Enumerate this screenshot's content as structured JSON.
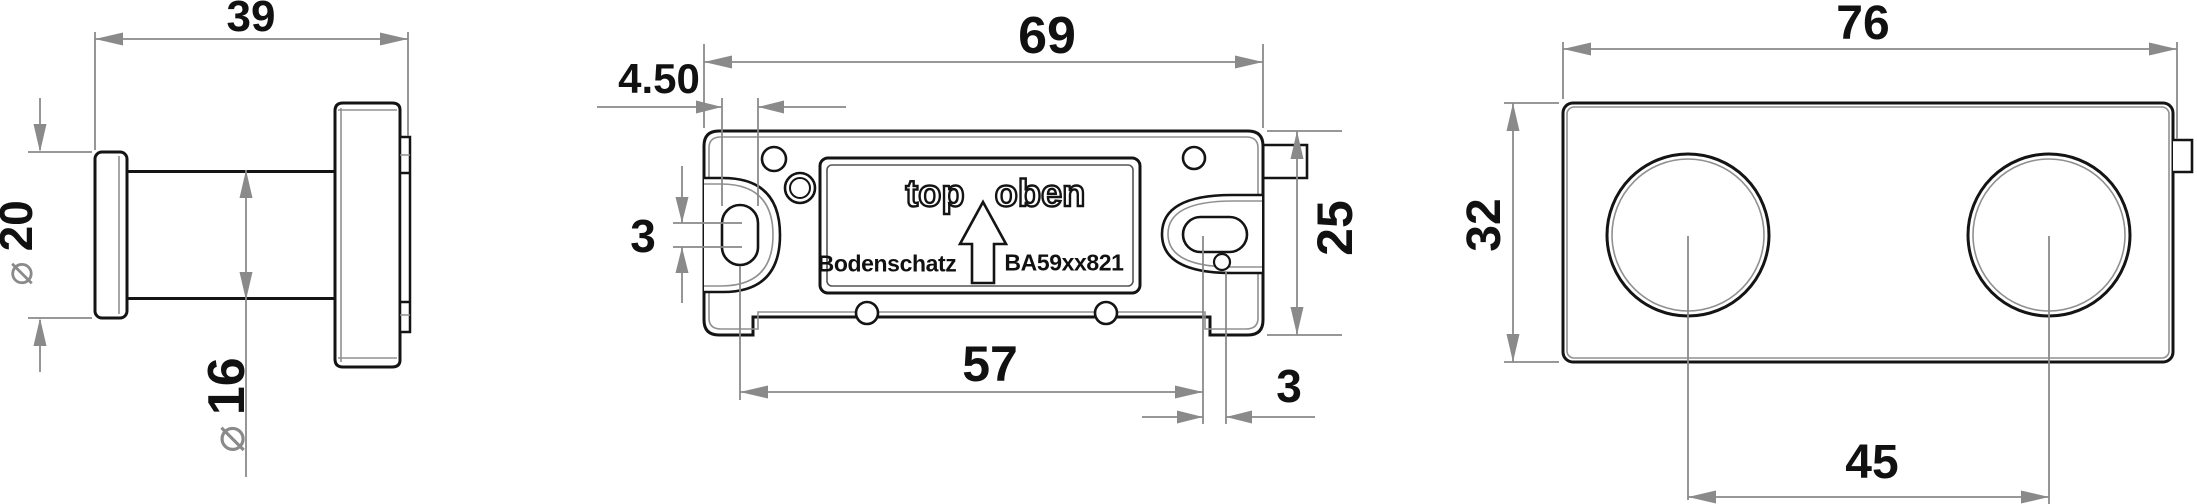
{
  "drawing_title": "Bodenschatz wall hook - dimensioned technical drawing",
  "symbols": {
    "diameter": "⌀"
  },
  "views": {
    "side": {
      "width": "39",
      "knob_diameter": "20",
      "shaft_diameter": "16"
    },
    "back": {
      "width": "69",
      "slot_width": "4.50",
      "slot_travel": "3",
      "height": "25",
      "slot_spacing": "57",
      "hole_offset": "3",
      "label_top": "top",
      "label_oben": "oben",
      "brand": "Bodenschatz",
      "model": "BA59xx821"
    },
    "front": {
      "width": "76",
      "height": "32",
      "center_distance": "45"
    }
  },
  "colors": {
    "outline": "#141414",
    "inner_detail": "#909090",
    "dimension": "#8a8a8a",
    "background": "#ffffff"
  }
}
